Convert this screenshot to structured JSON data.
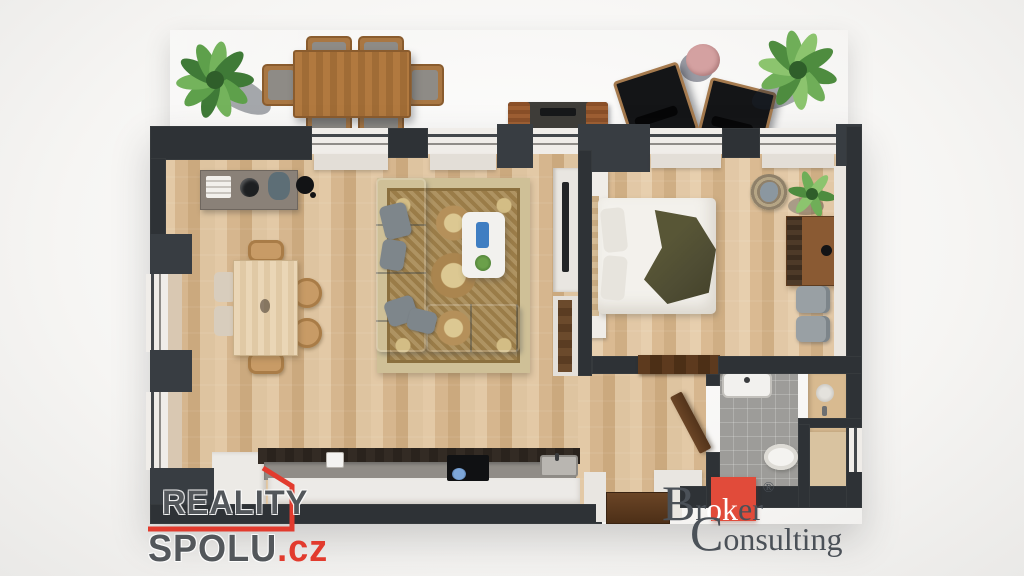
{
  "watermark_left": {
    "line1": "REALITY",
    "line2": "SPOLU",
    "tld": ".cz"
  },
  "watermark_right": {
    "initial": "B",
    "pre": "r",
    "highlight": "ok",
    "post": "er",
    "reg": "®",
    "line2_initial": "C",
    "line2_rest": "onsulting"
  },
  "colors": {
    "brand_red": "#e23b2e",
    "logo_gray": "#53575b",
    "broker_gray": "#4b5158",
    "wall_dark": "#2e3236",
    "floor_wood": "#d8b991",
    "terrace_gray": "#a8a5a0",
    "sofa_gray": "#9ba2a6",
    "rug_gold": "#a1834e",
    "blanket_olive": "#4e4c33",
    "plant_green": "#4e8c3f",
    "side_table_pink": "#d4a1a1"
  }
}
